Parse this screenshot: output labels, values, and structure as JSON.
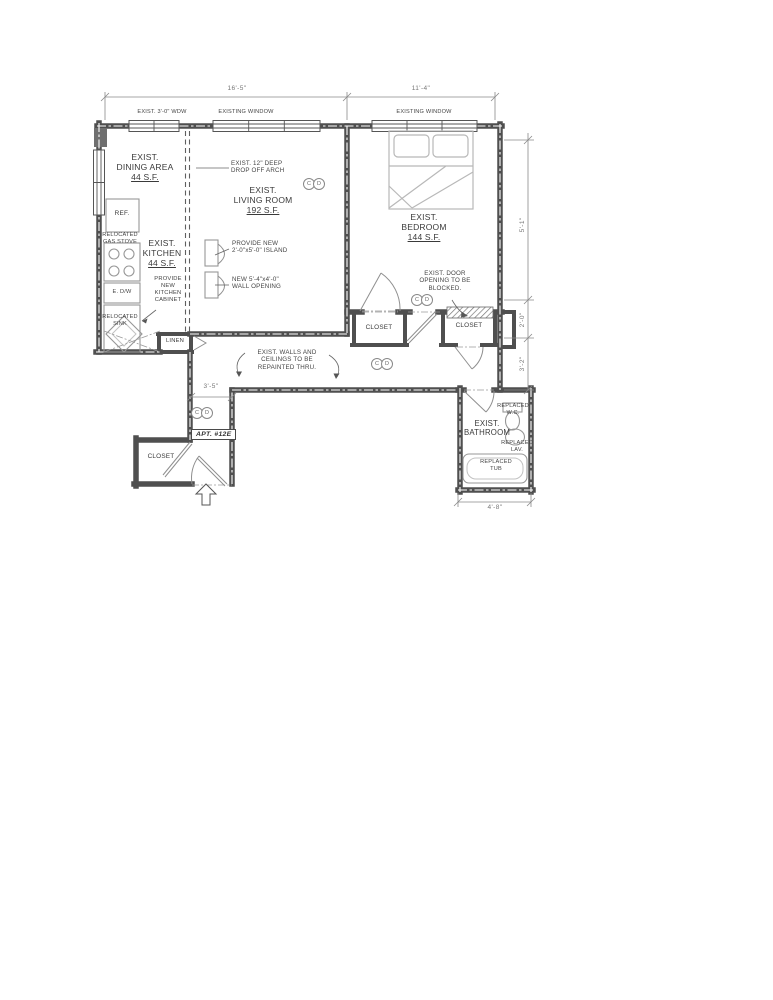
{
  "plan": {
    "apartment_tag": "APT. #12E",
    "windows": {
      "w1": "EXIST. 3'-0\" WDW",
      "w2": "EXISTING WINDOW",
      "w3": "EXISTING WINDOW"
    },
    "rooms": {
      "dining": {
        "l1": "EXIST.",
        "l2": "DINING AREA",
        "area": "44 S.F."
      },
      "kitchen": {
        "l1": "EXIST.",
        "l2": "KITCHEN",
        "area": "44 S.F."
      },
      "living": {
        "l1": "EXIST.",
        "l2": "LIVING ROOM",
        "area": "192 S.F."
      },
      "bedroom": {
        "l1": "EXIST.",
        "l2": "BEDROOM",
        "area": "144 S.F."
      },
      "bathroom": {
        "l1": "EXIST.",
        "l2": "BATHROOM"
      }
    },
    "fixtures": {
      "refrigerator": "REF.",
      "dishwasher": "E. D/W",
      "linen": "LINEN",
      "closet": "CLOSET"
    },
    "annotations": {
      "drop_arch": {
        "l1": "EXIST. 12\" DEEP",
        "l2": "DROP OFF ARCH"
      },
      "island": {
        "l1": "PROVIDE NEW",
        "l2": "2'-0\"x5'-0\" ISLAND"
      },
      "wall_opening": {
        "l1": "NEW 5'-4\"x4'-0\"",
        "l2": "WALL OPENING"
      },
      "kitchen_cabinet": {
        "l1": "PROVIDE",
        "l2": "NEW",
        "l3": "KITCHEN",
        "l4": "CABINET"
      },
      "gas_stove": {
        "l1": "RELOCATED",
        "l2": "GAS STOVE"
      },
      "sink": {
        "l1": "RELOCATED",
        "l2": "SINK"
      },
      "repaint": {
        "l1": "EXIST. WALLS AND",
        "l2": "CEILINGS TO BE",
        "l3": "REPAINTED THRU."
      },
      "blocked_door": {
        "l1": "EXIST. DOOR",
        "l2": "OPENING TO BE",
        "l3": "BLOCKED."
      },
      "wc": {
        "l1": "REPLACED",
        "l2": "W.C."
      },
      "lav": {
        "l1": "REPLACED",
        "l2": "LAV."
      },
      "tub": {
        "l1": "REPLACED",
        "l2": "TUB"
      }
    },
    "dimensions": {
      "top_left": "16'-5\"",
      "top_right": "11'-4\"",
      "right_upper": "5'-1\"",
      "right_mid": "2'-0\"",
      "right_lower": "3'-2\"",
      "hall": "3'-5\"",
      "bath": "4'-8\""
    },
    "detector": {
      "c": "C",
      "d": "D"
    }
  }
}
